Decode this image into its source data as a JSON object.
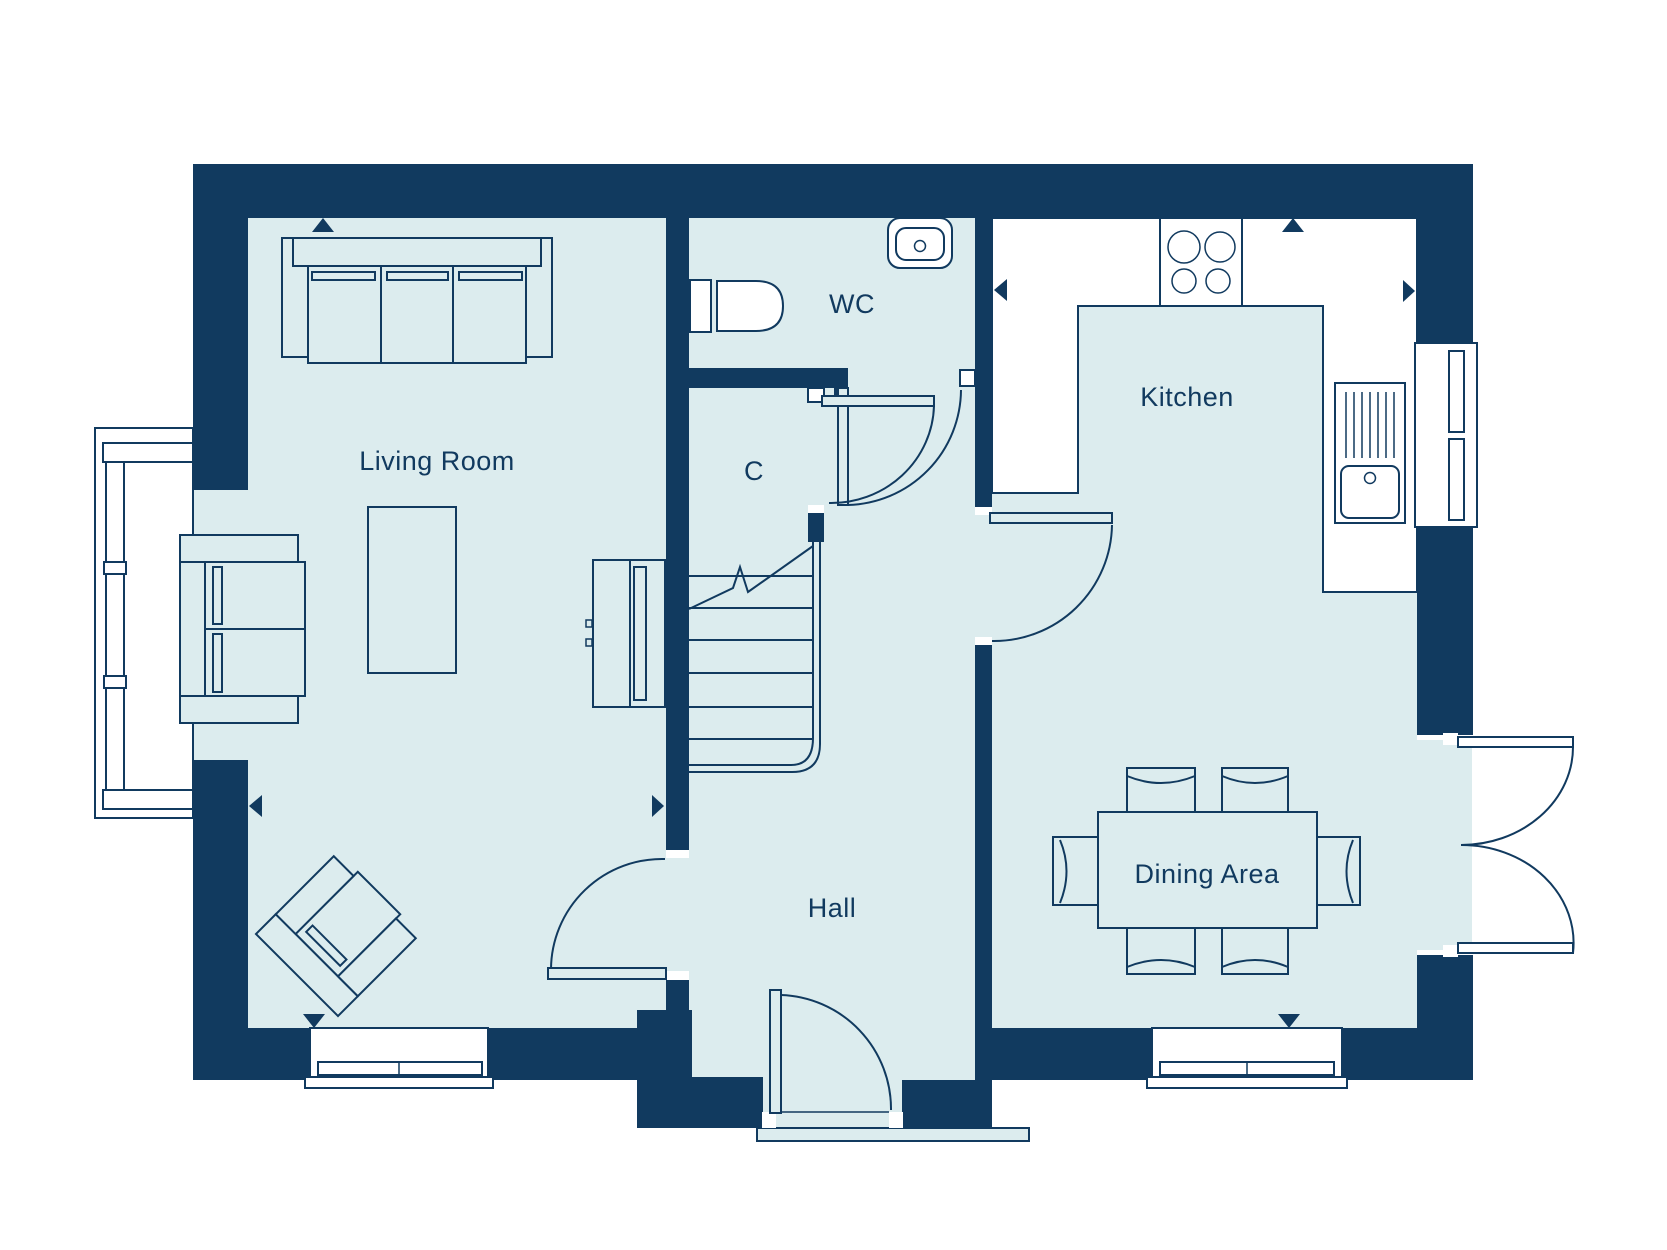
{
  "colors": {
    "wall": "#113a5f",
    "floor": "#dcecee"
  },
  "rooms": {
    "living_room": {
      "label": "Living Room"
    },
    "wc": {
      "label": "WC"
    },
    "closet": {
      "label": "C"
    },
    "hall": {
      "label": "Hall"
    },
    "kitchen": {
      "label": "Kitchen"
    },
    "dining_area": {
      "label": "Dining Area"
    }
  }
}
